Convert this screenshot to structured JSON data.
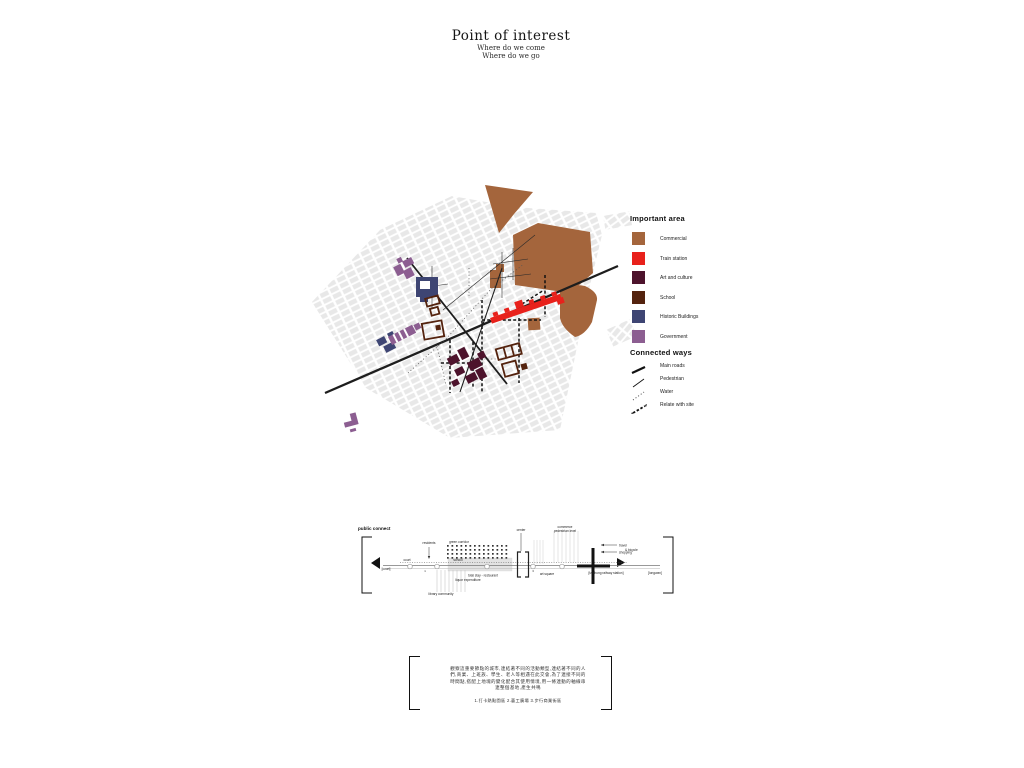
{
  "header": {
    "title": "Point of interest",
    "subtitle1": "Where do we come",
    "subtitle2": "Where do we go"
  },
  "legend": {
    "important_title": "Important area",
    "important": [
      {
        "label": "Commercial",
        "color": "#A4653C"
      },
      {
        "label": "Train station",
        "color": "#E8211B"
      },
      {
        "label": "Art and culture",
        "color": "#4D132C"
      },
      {
        "label": "School",
        "color": "#54230E"
      },
      {
        "label": "Historic Buildings",
        "color": "#3E4573"
      },
      {
        "label": "Government",
        "color": "#8C5E91"
      }
    ],
    "connected_title": "Connected ways",
    "connected": [
      {
        "label": "Main roads",
        "style": "solid-thick"
      },
      {
        "label": "Pedestrian",
        "style": "solid-thin"
      },
      {
        "label": "Water",
        "style": "dotted"
      },
      {
        "label": "Relate with site",
        "style": "dashed-arrows"
      }
    ]
  },
  "map": {
    "colors": {
      "fabric": "#E8E8E8",
      "road": "#1D1D1D",
      "commercial": "#A4653C",
      "train_station": "#E8211B",
      "art_culture": "#4D132C",
      "school": "#54230E",
      "historic": "#3E4573",
      "government": "#8C5E91"
    }
  },
  "diagram": {
    "title": "public connect",
    "labels": {
      "court": "court",
      "school": "school",
      "residents": "residents",
      "green_corridor": "green corridor",
      "center": "center",
      "commerce1": "commerce",
      "commerce2": "pedestrian level",
      "bicycle": "& bicycle",
      "travel": "travel",
      "shopping": "shopping",
      "art_square": "art square",
      "retail": "total stay - restaurant",
      "liquor": "liquor expenditure",
      "library": "library community",
      "left_anchor": "[court]",
      "station": "[taichung railway station]",
      "right_anchor": "[longwan]",
      "marker1": "1",
      "marker3": "3"
    }
  },
  "footer": {
    "paragraph_lines": [
      "觀察這重要節點的城市,連結著不同的活動類型,連結著不同的人",
      "們,商業、上班族、學生、老人等相遇在此交會,為了連接不同的",
      "時間點,搭配上地塊的變化配合其使用情境,用一條連動的軸線串",
      "連整個基地,產生共鳴"
    ],
    "caption": "1.打卡熱點園區  2.藝工廣場  3.步行商業街區"
  }
}
